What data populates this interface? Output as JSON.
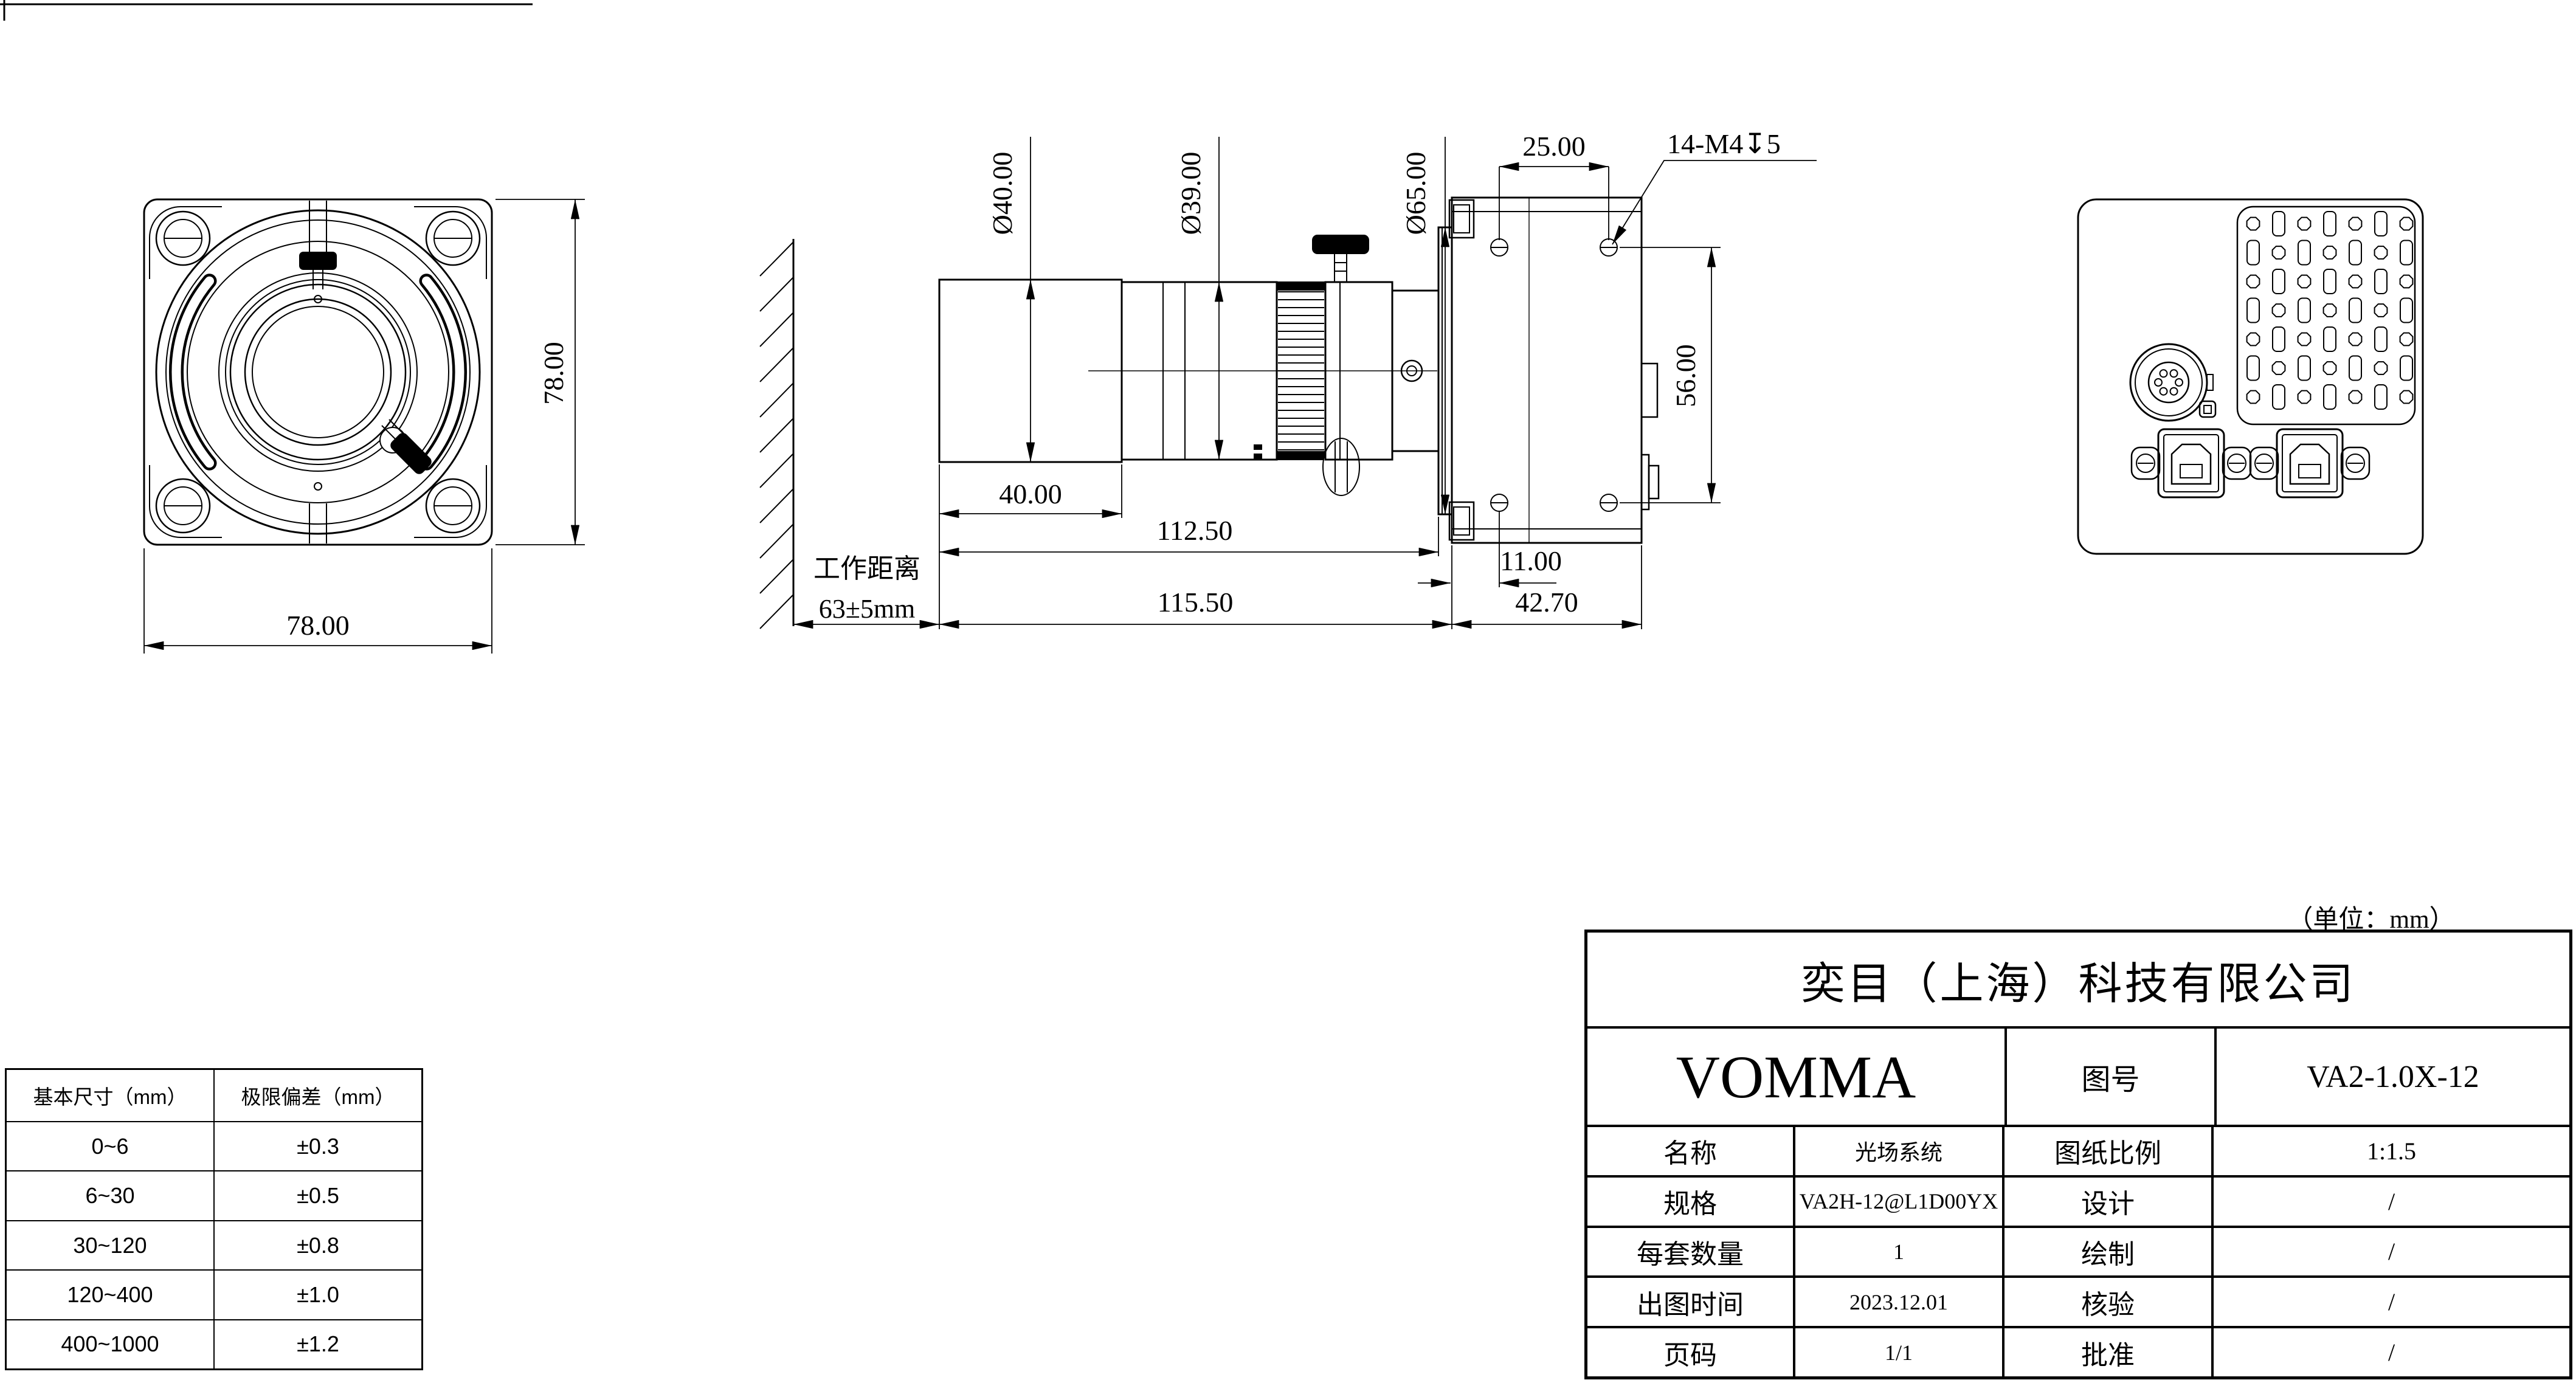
{
  "sheet": {
    "unit_note": "（单位：mm）"
  },
  "front_view": {
    "dim_width": "78.00",
    "dim_height": "78.00"
  },
  "side_view": {
    "dia_40": "Ø40.00",
    "dia_39": "Ø39.00",
    "dia_65": "Ø65.00",
    "dim_25": "25.00",
    "thread_callout": "14-M4↧5",
    "dim_56": "56.00",
    "dim_40": "40.00",
    "dim_112_5": "112.50",
    "dim_11": "11.00",
    "dim_115_5": "115.50",
    "dim_42_7": "42.70",
    "working_distance_label": "工作距离",
    "working_distance_value": "63±5mm"
  },
  "tolerance_table": {
    "headers": [
      "基本尺寸（mm）",
      "极限偏差（mm）"
    ],
    "rows": [
      [
        "0~6",
        "±0.3"
      ],
      [
        "6~30",
        "±0.5"
      ],
      [
        "30~120",
        "±0.8"
      ],
      [
        "120~400",
        "±1.0"
      ],
      [
        "400~1000",
        "±1.2"
      ]
    ]
  },
  "title_block": {
    "company": "奕目（上海）科技有限公司",
    "brand": "VOMMA",
    "drawing_no_label": "图号",
    "drawing_no": "VA2-1.0X-12",
    "rows": [
      {
        "l1": "名称",
        "v1": "光场系统",
        "l2": "图纸比例",
        "v2": "1:1.5"
      },
      {
        "l1": "规格",
        "v1": "VA2H-12@L1D00YX",
        "l2": "设计",
        "v2": "/"
      },
      {
        "l1": "每套数量",
        "v1": "1",
        "l2": "绘制",
        "v2": "/"
      },
      {
        "l1": "出图时间",
        "v1": "2023.12.01",
        "l2": "核验",
        "v2": "/"
      },
      {
        "l1": "页码",
        "v1": "1/1",
        "l2": "批准",
        "v2": "/"
      }
    ]
  }
}
